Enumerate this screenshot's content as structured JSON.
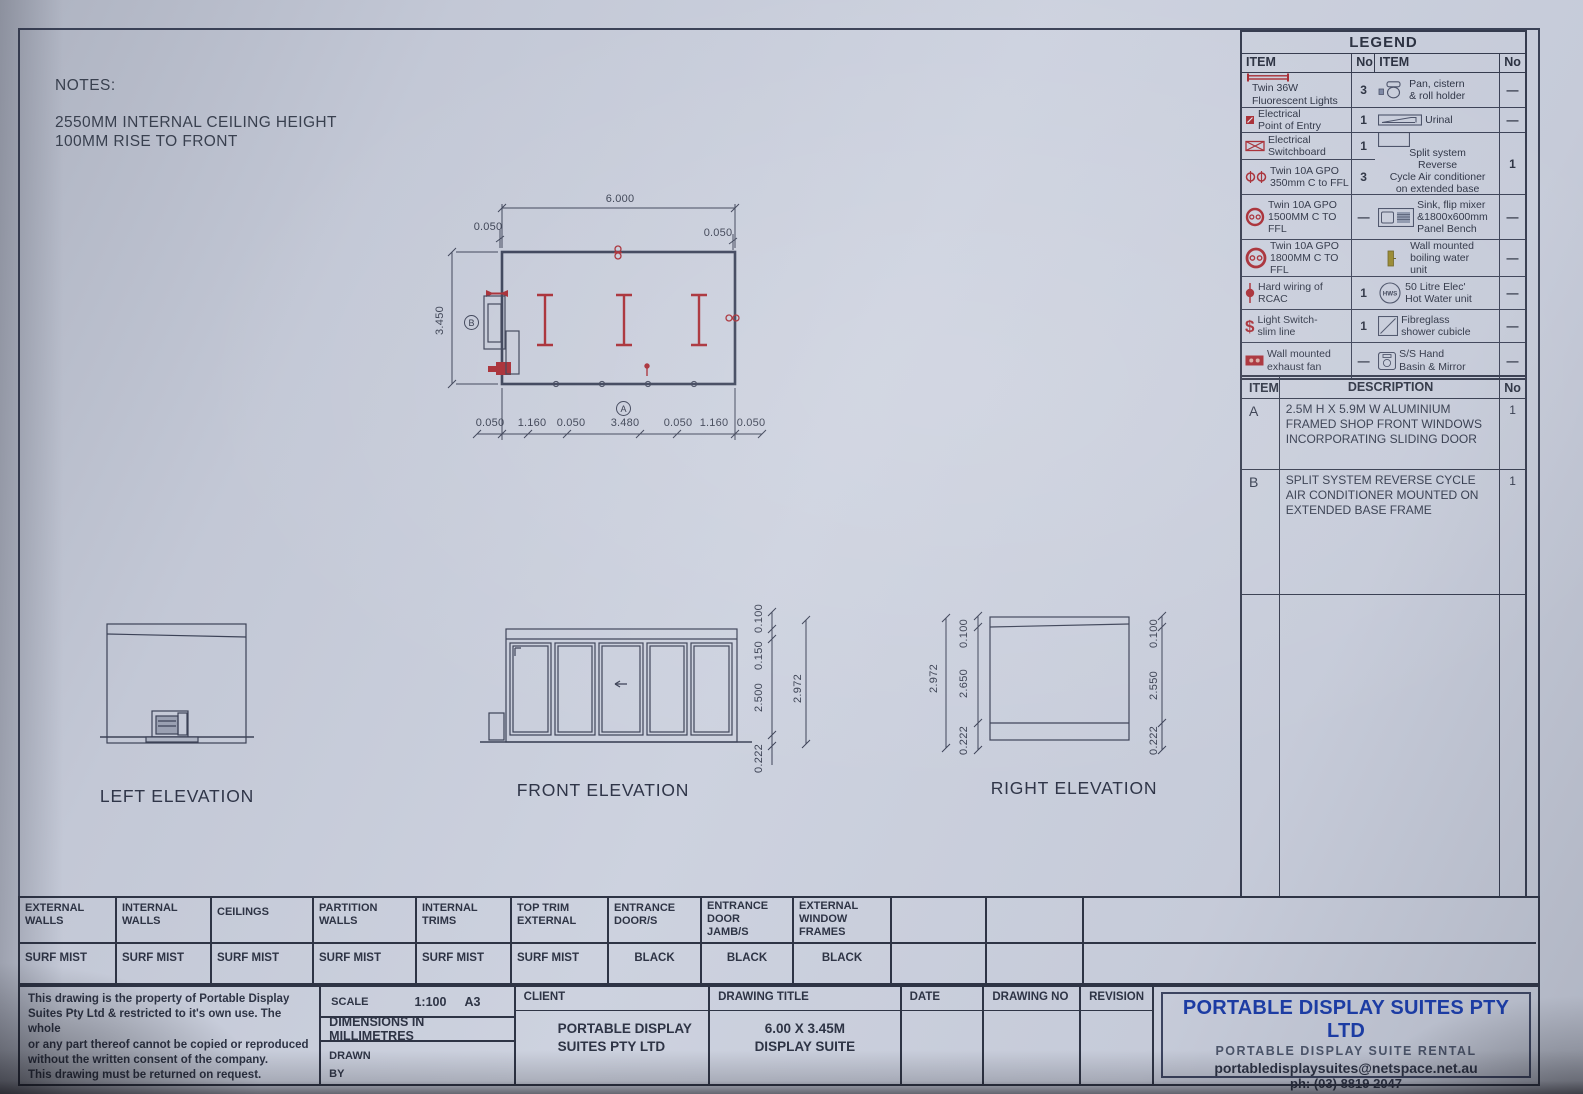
{
  "colors": {
    "accent_red": "#a72b33",
    "company_blue": "#1c3ca3",
    "line": "#3c4257",
    "paper": "#cdd2df"
  },
  "notes": {
    "title": "NOTES:",
    "line1": "2550MM INTERNAL CEILING HEIGHT",
    "line2": "100MM RISE TO FRONT"
  },
  "plan": {
    "dim_top": "6.000",
    "dim_side": "3.450",
    "off_top_left": "0.050",
    "off_top_right": "0.050",
    "bottom_dims": [
      "0.050",
      "1.160",
      "0.050",
      "3.480",
      "0.050",
      "1.160",
      "0.050"
    ],
    "marker_a": "A",
    "marker_b": "B"
  },
  "elevations": {
    "left": {
      "title": "LEFT ELEVATION"
    },
    "front": {
      "title": "FRONT ELEVATION",
      "dim_0100": "0.100",
      "dim_0150": "0.150",
      "dim_2500": "2.500",
      "dim_0222": "0.222",
      "dim_total": "2.972"
    },
    "right": {
      "title": "RIGHT ELEVATION",
      "dim_total": "2.972",
      "left_0100": "0.100",
      "left_2650": "2.650",
      "left_0222": "0.222",
      "right_0100": "0.100",
      "right_2550": "2.550",
      "right_0222": "0.222"
    }
  },
  "legend": {
    "title": "LEGEND",
    "col_item": "ITEM",
    "col_no": "No",
    "light_switch_glyph": "$",
    "hws_label": "HWS",
    "left_items": [
      {
        "label": "Twin 36W\nFluorescent Lights",
        "no": "3"
      },
      {
        "label": "Electrical\nPoint of Entry",
        "no": "1"
      },
      {
        "label": "Electrical\nSwitchboard",
        "no": "1"
      },
      {
        "label": "Twin 10A GPO\n350mm C to FFL",
        "no": "3"
      },
      {
        "label": "Twin 10A GPO\n1500MM C TO FFL",
        "no": "—"
      },
      {
        "label": "Twin 10A GPO\n1800MM C TO FFL",
        "no": ""
      },
      {
        "label": "Hard wiring of\nRCAC",
        "no": "1"
      },
      {
        "label": "Light Switch-\nslim line",
        "no": "1"
      },
      {
        "label": "Wall mounted\nexhaust fan",
        "no": "—"
      }
    ],
    "right_items": [
      {
        "label": "Pan, cistern\n& roll holder",
        "no": "—"
      },
      {
        "label": "Urinal",
        "no": "—"
      },
      {
        "label": "Split system\nReverse\nCycle Air conditioner\non extended base",
        "no": "1"
      },
      {
        "label": "Sink, flip mixer\n&1800x600mm\nPanel Bench",
        "no": "—"
      },
      {
        "label": "Wall mounted\nboiling water\nunit",
        "no": "—"
      },
      {
        "label": "50 Litre Elec'\nHot Water unit",
        "no": "—"
      },
      {
        "label": "Fibreglass\nshower cubicle",
        "no": "—"
      },
      {
        "label": "S/S Hand\nBasin & Mirror",
        "no": "—"
      }
    ]
  },
  "items_table": {
    "col_item": "ITEM",
    "col_desc": "DESCRIPTION",
    "col_no": "No",
    "rows": [
      {
        "item": "A",
        "desc": "2.5M H X 5.9M W ALUMINIUM FRAMED SHOP FRONT WINDOWS INCORPORATING SLIDING DOOR",
        "no": "1"
      },
      {
        "item": "B",
        "desc": "SPLIT SYSTEM REVERSE CYCLE AIR CONDITIONER MOUNTED ON EXTENDED BASE FRAME",
        "no": "1"
      }
    ]
  },
  "finishes": {
    "cols": [
      {
        "label": "EXTERNAL\nWALLS",
        "value": "SURF MIST"
      },
      {
        "label": "INTERNAL\nWALLS",
        "value": "SURF MIST"
      },
      {
        "label": "CEILINGS",
        "value": "SURF MIST"
      },
      {
        "label": "PARTITION\nWALLS",
        "value": "SURF MIST"
      },
      {
        "label": "INTERNAL\nTRIMS",
        "value": "SURF MIST"
      },
      {
        "label": "TOP TRIM\nEXTERNAL",
        "value": "SURF MIST"
      },
      {
        "label": "ENTRANCE\nDOOR/S",
        "value": "BLACK"
      },
      {
        "label": "ENTRANCE\nDOOR\nJAMB/S",
        "value": "BLACK"
      },
      {
        "label": "EXTERNAL\nWINDOW\nFRAMES",
        "value": "BLACK"
      }
    ]
  },
  "title_block": {
    "copyright": "This drawing is the property of Portable Display\nSuites Pty Ltd & restricted to it's own use. The whole\nor any part thereof cannot be copied or reproduced\nwithout the written consent of the company.\nThis drawing must be returned on request.",
    "scale_label": "SCALE",
    "scale_value": "1:100",
    "sheet_size": "A3",
    "dims_note": "DIMENSIONS IN MILLIMETRES",
    "drawn_by": "DRAWN\nBY",
    "client_label": "CLIENT",
    "client_value": "PORTABLE DISPLAY\nSUITES PTY LTD",
    "drawing_title_label": "DRAWING TITLE",
    "drawing_title_value": "6.00 X 3.45M\nDISPLAY SUITE",
    "date_label": "DATE",
    "drawing_no_label": "DRAWING NO",
    "revision_label": "REVISION",
    "company_name": "PORTABLE DISPLAY SUITES PTY LTD",
    "company_sub": "PORTABLE DISPLAY SUITE RENTAL",
    "company_email": "portabledisplaysuites@netspace.net.au",
    "company_phone": "ph: (03) 8819 2047"
  }
}
